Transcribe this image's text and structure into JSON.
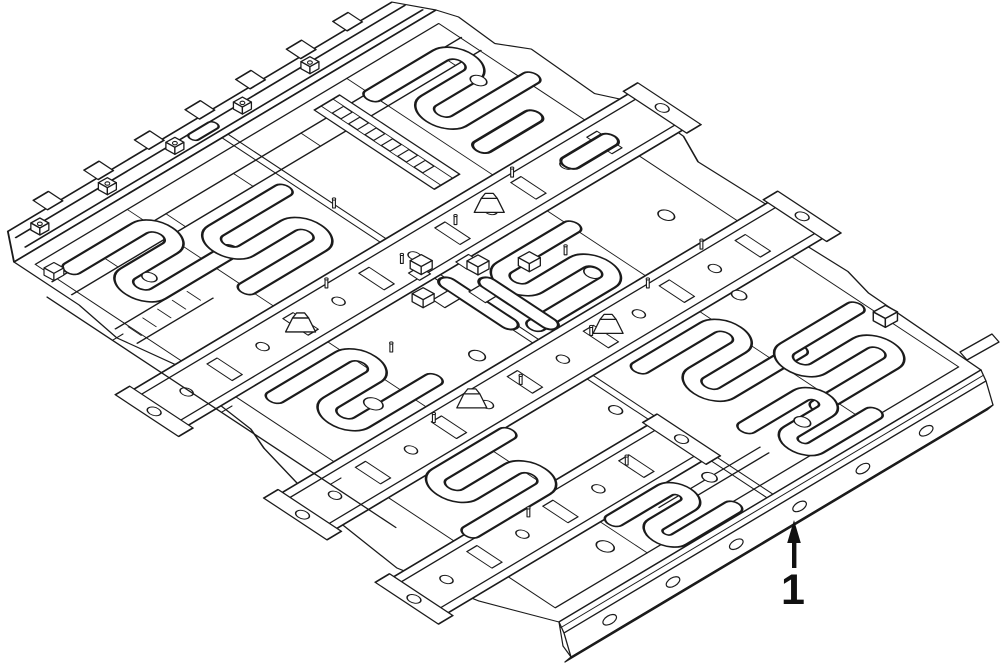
{
  "canvas": {
    "width": 1000,
    "height": 664,
    "background": "#ffffff",
    "ink": "#1b1b1b"
  },
  "figure": {
    "type": "isometric-parts-line-drawing",
    "subject": "vehicle floor pan panel",
    "callout": {
      "label": "1"
    }
  }
}
